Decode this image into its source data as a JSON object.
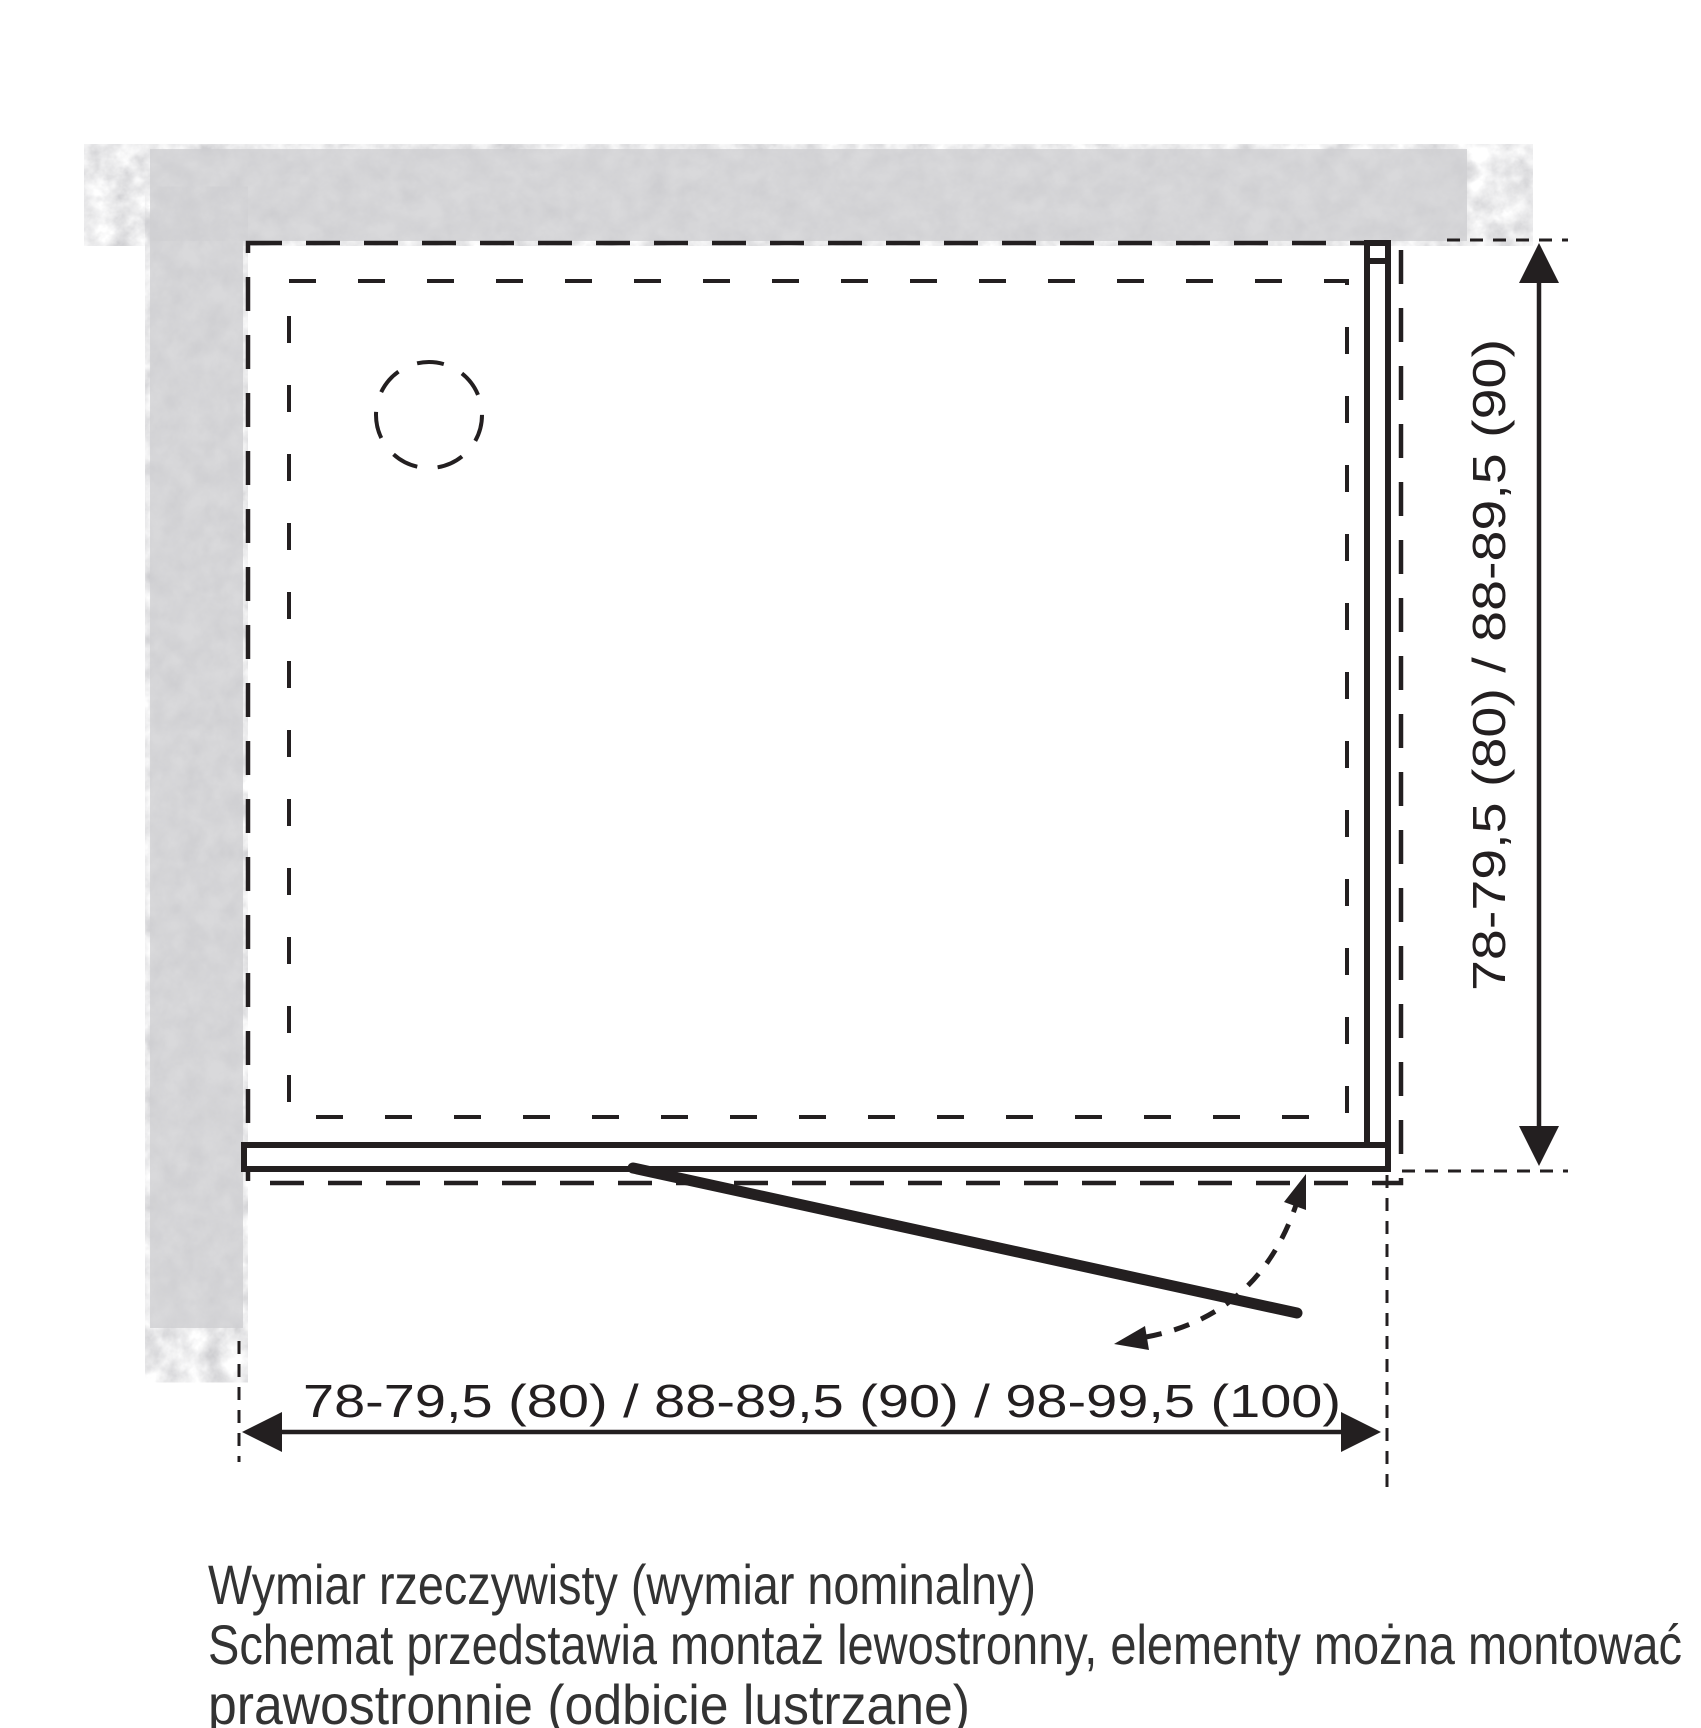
{
  "diagram": {
    "title": "shower-enclosure-installation-top-view",
    "vertical_dimension": {
      "label": "78-79,5 (80) / 88-89,5 (90)"
    },
    "horizontal_dimension": {
      "label": "78-79,5 (80) / 88-89,5 (90) / 98-99,5 (100)"
    },
    "caption": {
      "line1": "Wymiar rzeczywisty (wymiar nominalny)",
      "line2": "Schemat przedstawia montaż lewostronny, elementy można montować",
      "line3": "prawostronnie (odbicie lustrzane)"
    },
    "colors": {
      "line": "#231f20",
      "wall_fill": "#d9d9db",
      "wall_speckle": "#a9a9ae",
      "background": "#ffffff",
      "caption_text": "#333333"
    }
  }
}
